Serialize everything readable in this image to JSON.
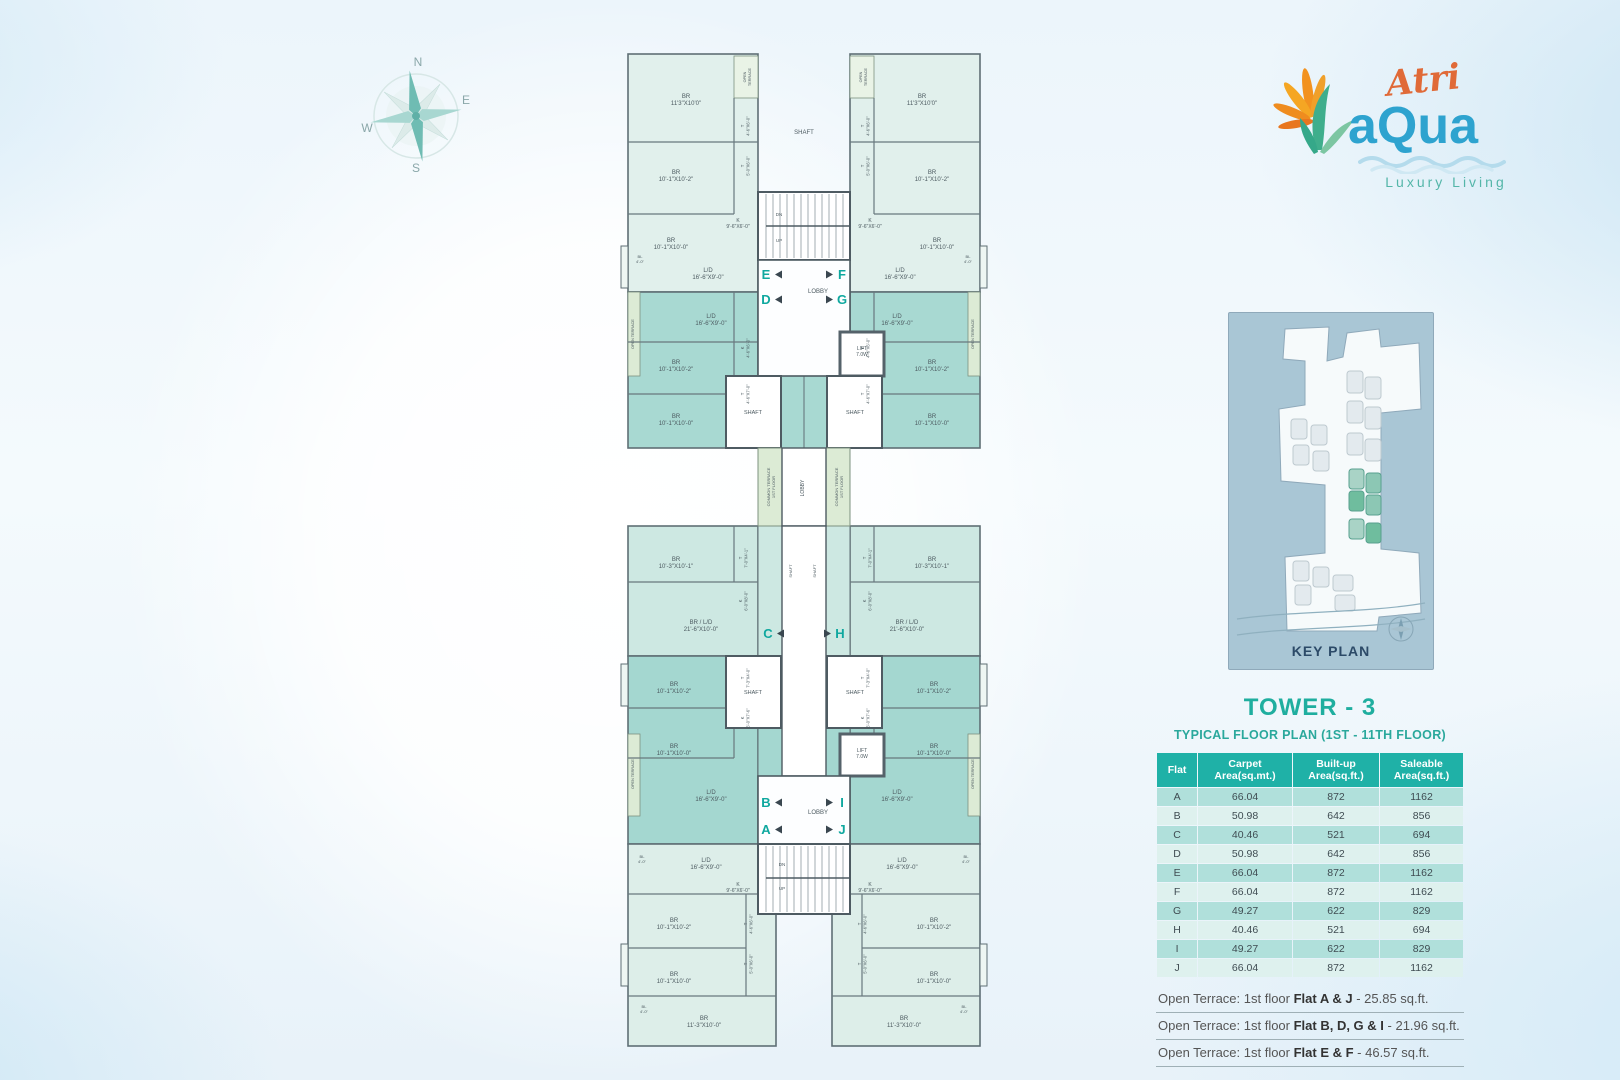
{
  "compass": {
    "n": "N",
    "e": "E",
    "s": "S",
    "w": "W"
  },
  "logo": {
    "brand_script": "Atri",
    "brand_main": "aQua",
    "tagline": "Luxury Living",
    "colors": {
      "script": "#e06a38",
      "main": "#2ea3cf",
      "tagline": "#54b6a9",
      "petal": "#f2921f",
      "leaf": "#3fae8c"
    }
  },
  "key_plan": {
    "title": "KEY PLAN"
  },
  "panel": {
    "title": "TOWER - 3",
    "subtitle": "TYPICAL FLOOR PLAN  (1ST - 11TH FLOOR)",
    "table": {
      "headers": [
        "Flat",
        "Carpet Area(sq.mt.)",
        "Built-up Area(sq.ft.)",
        "Saleable Area(sq.ft.)"
      ],
      "rows": [
        [
          "A",
          "66.04",
          "872",
          "1162"
        ],
        [
          "B",
          "50.98",
          "642",
          "856"
        ],
        [
          "C",
          "40.46",
          "521",
          "694"
        ],
        [
          "D",
          "50.98",
          "642",
          "856"
        ],
        [
          "E",
          "66.04",
          "872",
          "1162"
        ],
        [
          "F",
          "66.04",
          "872",
          "1162"
        ],
        [
          "G",
          "49.27",
          "622",
          "829"
        ],
        [
          "H",
          "40.46",
          "521",
          "694"
        ],
        [
          "I",
          "49.27",
          "622",
          "829"
        ],
        [
          "J",
          "66.04",
          "872",
          "1162"
        ]
      ]
    },
    "notes": [
      {
        "prefix": "Open Terrace: 1st floor ",
        "bold": "Flat A & J",
        "suffix": " - 25.85 sq.ft."
      },
      {
        "prefix": "Open Terrace: 1st floor ",
        "bold": "Flat B, D, G & I",
        "suffix": " - 21.96 sq.ft."
      },
      {
        "prefix": "Open Terrace: 1st floor ",
        "bold": "Flat E & F",
        "suffix": " - 46.57 sq.ft."
      }
    ]
  },
  "floorplan": {
    "flat_letter_color": "#0fa89f",
    "flat_markers": [
      {
        "letter": "E",
        "x": 150,
        "y": 233,
        "side": "L"
      },
      {
        "letter": "F",
        "x": 226,
        "y": 233,
        "side": "R"
      },
      {
        "letter": "D",
        "x": 150,
        "y": 258,
        "side": "L"
      },
      {
        "letter": "G",
        "x": 226,
        "y": 258,
        "side": "R"
      },
      {
        "letter": "C",
        "x": 152,
        "y": 592,
        "side": "L"
      },
      {
        "letter": "H",
        "x": 224,
        "y": 592,
        "side": "R"
      },
      {
        "letter": "B",
        "x": 150,
        "y": 761,
        "side": "L"
      },
      {
        "letter": "I",
        "x": 226,
        "y": 761,
        "side": "R"
      },
      {
        "letter": "A",
        "x": 150,
        "y": 788,
        "side": "L"
      },
      {
        "letter": "J",
        "x": 226,
        "y": 788,
        "side": "R"
      }
    ],
    "labels": [
      {
        "t": [
          "SHAFT"
        ],
        "x": 188,
        "y": 88,
        "s": 6
      },
      {
        "t": [
          "DN"
        ],
        "x": 163,
        "y": 170,
        "s": 4.5
      },
      {
        "t": [
          "UP"
        ],
        "x": 163,
        "y": 196,
        "s": 4.5
      },
      {
        "t": [
          "LOBBY"
        ],
        "x": 202,
        "y": 247,
        "s": 6
      },
      {
        "t": [
          "LIFT",
          "7.0W"
        ],
        "x": 246,
        "y": 304,
        "s": 5
      },
      {
        "t": [
          "SHAFT"
        ],
        "x": 137,
        "y": 368,
        "s": 5.5
      },
      {
        "t": [
          "SHAFT"
        ],
        "x": 239,
        "y": 368,
        "s": 5.5
      },
      {
        "t": [
          "COMMON TERRACE",
          "1ST FLOOR"
        ],
        "x": 154,
        "y": 441,
        "s": 4,
        "r": -90
      },
      {
        "t": [
          "LOBBY"
        ],
        "x": 188,
        "y": 442,
        "s": 5,
        "r": -90
      },
      {
        "t": [
          "COMMON TERRACE",
          "1ST FLOOR"
        ],
        "x": 222,
        "y": 441,
        "s": 4,
        "r": -90
      },
      {
        "t": [
          "SHAFT"
        ],
        "x": 176,
        "y": 525,
        "s": 4,
        "r": -90
      },
      {
        "t": [
          "SHAFT"
        ],
        "x": 200,
        "y": 525,
        "s": 4,
        "r": -90
      },
      {
        "t": [
          "SHAFT"
        ],
        "x": 137,
        "y": 648,
        "s": 5.5
      },
      {
        "t": [
          "SHAFT"
        ],
        "x": 239,
        "y": 648,
        "s": 5.5
      },
      {
        "t": [
          "LIFT",
          "7.0W"
        ],
        "x": 246,
        "y": 706,
        "s": 5
      },
      {
        "t": [
          "LOBBY"
        ],
        "x": 202,
        "y": 768,
        "s": 6
      },
      {
        "t": [
          "DN"
        ],
        "x": 166,
        "y": 820,
        "s": 4.5
      },
      {
        "t": [
          "UP"
        ],
        "x": 166,
        "y": 844,
        "s": 4.5
      },
      {
        "t": [
          "BR",
          "11'3\"X10'0\""
        ],
        "x": 70,
        "y": 52,
        "s": 6,
        "m": true
      },
      {
        "t": [
          "OPEN",
          "TERRACE"
        ],
        "x": 130,
        "y": 31,
        "s": 3.8,
        "r": -90,
        "m": true
      },
      {
        "t": [
          "T",
          "4'-6\"X6'-0\""
        ],
        "x": 128,
        "y": 80,
        "s": 4.2,
        "r": -90,
        "m": true
      },
      {
        "t": [
          "T",
          "5'-0\"X6'-0\""
        ],
        "x": 128,
        "y": 120,
        "s": 4.2,
        "r": -90,
        "m": true
      },
      {
        "t": [
          "BR",
          "10'-1\"X10'-2\""
        ],
        "x": 60,
        "y": 128,
        "s": 6,
        "m": true
      },
      {
        "t": [
          "K",
          "9'-6\"X6'-0\""
        ],
        "x": 122,
        "y": 176,
        "s": 5,
        "m": true
      },
      {
        "t": [
          "BR",
          "10'-1\"X10'-0\""
        ],
        "x": 55,
        "y": 196,
        "s": 6,
        "m": true
      },
      {
        "t": [
          "BL",
          "4'-0\""
        ],
        "x": 24,
        "y": 212,
        "s": 4,
        "m": true
      },
      {
        "t": [
          "L/D",
          "16'-6\"X9'-0\""
        ],
        "x": 92,
        "y": 226,
        "s": 6,
        "m": true
      },
      {
        "t": [
          "L/D",
          "16'-6\"X9'-0\""
        ],
        "x": 95,
        "y": 272,
        "s": 6,
        "m": true
      },
      {
        "t": [
          "OPEN TERRACE"
        ],
        "x": 18,
        "y": 288,
        "s": 3.8,
        "r": -90,
        "m": true
      },
      {
        "t": [
          "K",
          "4'-6\"X6'-0\""
        ],
        "x": 128,
        "y": 302,
        "s": 4.2,
        "r": -90,
        "m": true
      },
      {
        "t": [
          "BR",
          "10'-1\"X10'-2\""
        ],
        "x": 60,
        "y": 318,
        "s": 6,
        "m": true
      },
      {
        "t": [
          "T",
          "4'-6\"X7'-0\""
        ],
        "x": 128,
        "y": 348,
        "s": 4.2,
        "r": -90,
        "m": true
      },
      {
        "t": [
          "BR",
          "10'-1\"X10'-0\""
        ],
        "x": 60,
        "y": 372,
        "s": 6,
        "m": true
      },
      {
        "t": [
          "BR",
          "10'-3\"X10'-1\""
        ],
        "x": 60,
        "y": 515,
        "s": 6,
        "m": true
      },
      {
        "t": [
          "T",
          "7'-0\"X4'-1\""
        ],
        "x": 126,
        "y": 512,
        "s": 4.2,
        "r": -90,
        "m": true
      },
      {
        "t": [
          "K",
          "6'-0\"X8'-0\""
        ],
        "x": 126,
        "y": 555,
        "s": 4.2,
        "r": -90,
        "m": true
      },
      {
        "t": [
          "BR / L/D",
          "21'-6\"X10'-0\""
        ],
        "x": 85,
        "y": 578,
        "s": 6,
        "m": true
      },
      {
        "t": [
          "T",
          "7'-3\"X4'-0\""
        ],
        "x": 128,
        "y": 632,
        "s": 4.2,
        "r": -90,
        "m": true
      },
      {
        "t": [
          "BR",
          "10'-1\"X10'-2\""
        ],
        "x": 58,
        "y": 640,
        "s": 6,
        "m": true
      },
      {
        "t": [
          "K",
          "6'-0\"X7'-6\""
        ],
        "x": 128,
        "y": 672,
        "s": 4.2,
        "r": -90,
        "m": true
      },
      {
        "t": [
          "BR",
          "10'-1\"X10'-0\""
        ],
        "x": 58,
        "y": 702,
        "s": 6,
        "m": true
      },
      {
        "t": [
          "OPEN TERRACE"
        ],
        "x": 18,
        "y": 728,
        "s": 3.8,
        "r": -90,
        "m": true
      },
      {
        "t": [
          "L/D",
          "16'-6\"X9'-0\""
        ],
        "x": 95,
        "y": 748,
        "s": 6,
        "m": true
      },
      {
        "t": [
          "BL",
          "4'-0\""
        ],
        "x": 26,
        "y": 812,
        "s": 4,
        "m": true
      },
      {
        "t": [
          "L/D",
          "16'-6\"X9'-0\""
        ],
        "x": 90,
        "y": 816,
        "s": 6,
        "m": true
      },
      {
        "t": [
          "K",
          "9'-6\"X6'-0\""
        ],
        "x": 122,
        "y": 840,
        "s": 5,
        "m": true
      },
      {
        "t": [
          "BR",
          "10'-1\"X10'-2\""
        ],
        "x": 58,
        "y": 876,
        "s": 6,
        "m": true
      },
      {
        "t": [
          "T",
          "4'-6\"X6'-0\""
        ],
        "x": 131,
        "y": 878,
        "s": 4.2,
        "r": -90,
        "m": true
      },
      {
        "t": [
          "T",
          "5'-0\"X6'-0\""
        ],
        "x": 131,
        "y": 918,
        "s": 4.2,
        "r": -90,
        "m": true
      },
      {
        "t": [
          "BR",
          "10'-1\"X10'-0\""
        ],
        "x": 58,
        "y": 930,
        "s": 6,
        "m": true
      },
      {
        "t": [
          "BL",
          "4'-0\""
        ],
        "x": 28,
        "y": 962,
        "s": 4,
        "m": true
      },
      {
        "t": [
          "BR",
          "11'-3\"X10'-0\""
        ],
        "x": 88,
        "y": 974,
        "s": 6,
        "m": true
      }
    ]
  }
}
